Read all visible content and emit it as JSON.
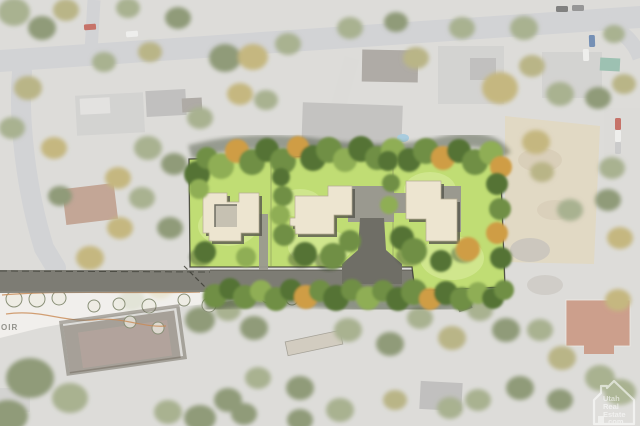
{
  "watermark": {
    "icon": "house-logo-icon",
    "line1": "Utah",
    "line2": "Real",
    "line3": "Estate",
    "line4": ".com"
  },
  "landscape_plan": {
    "label": "OIR"
  },
  "palette": {
    "aerialBase": "#d3d2ce",
    "aerialStreet": "#c4c5c8",
    "aerialConcrete": "#d1d0cc",
    "roofLight": "#c6c5c3",
    "roofMid": "#aeadab",
    "roofDark": "#96918a",
    "redRoof": "#bd8168",
    "brownRoof": "#b08a76",
    "darkHouse": "#8a8378",
    "mutedTree1": "#8e9a6e",
    "mutedTree2": "#a49e62",
    "mutedTree3": "#b3a158",
    "mutedTree4": "#6d7c50",
    "dirt": "#d8cdb2",
    "rubble": "#b5b0a8",
    "pool": "#8fbcd4",
    "fadeOverlay": "rgba(255,255,255,0.24)",
    "lawn": "#c0dd74",
    "lawnLight": "#dff0a6",
    "treeGreen1": "#6f8f44",
    "treeGreen2": "#557336",
    "treeGreen3": "#8fae55",
    "treeAutumn": "#cf9d44",
    "treeShadow": "#2e3b24",
    "buildingFill": "#ede5d0",
    "buildingEdge": "#b6ad94",
    "buildingShadow": "#56564c",
    "courtyard": "#c6c1b2",
    "paving": "#9a998f",
    "drive": "#6f6e66",
    "lane": "#7d7c74",
    "boundary": "#3a3a32",
    "planPaper": "rgba(248,247,242,0.72)",
    "planLine": "#c98a54",
    "planTree": "#8a9078",
    "planTreeFill": "rgba(236,235,226,0.75)",
    "planHouseOutline": "#6e675c",
    "planLabel": "#74746c",
    "watermark": "#ffffff",
    "carRed": "#b5473a",
    "carBlue": "#4a6e9e",
    "carWhite": "#e9e9e7",
    "carDark": "#5a5a58"
  }
}
